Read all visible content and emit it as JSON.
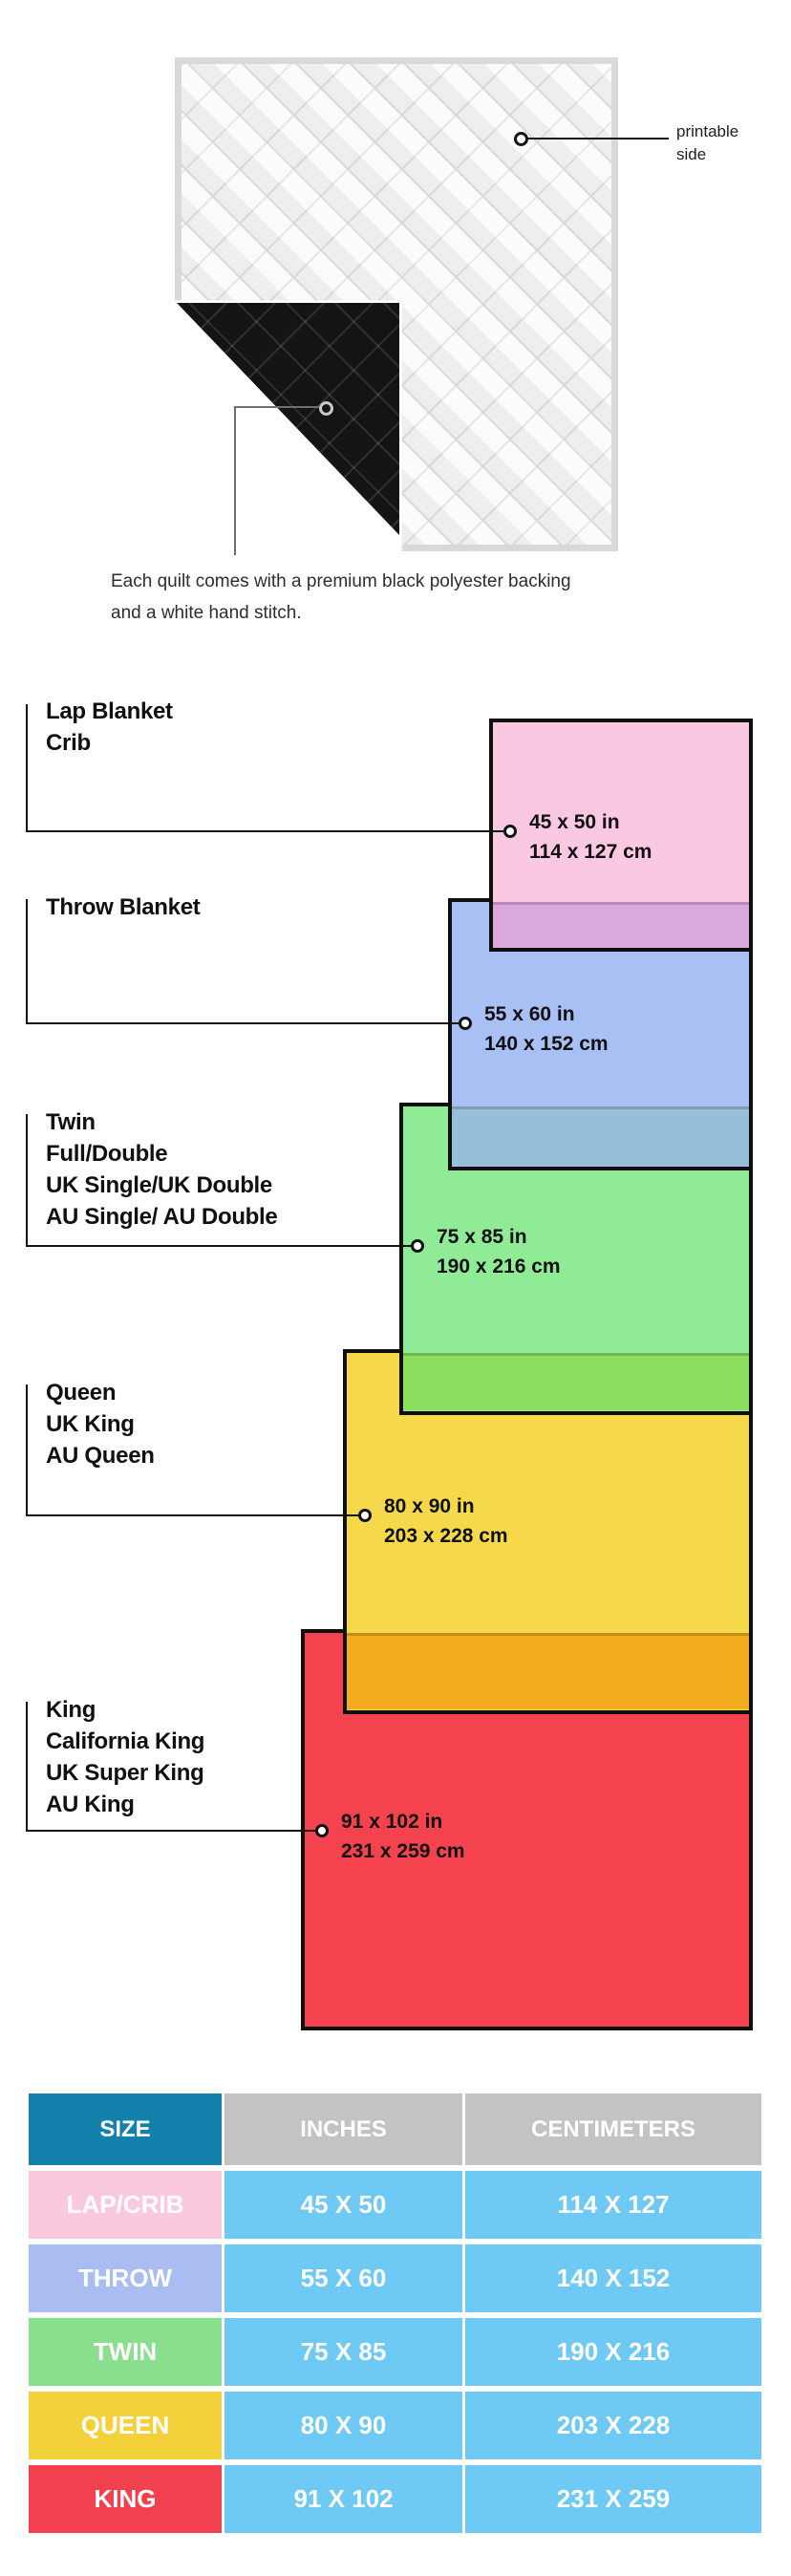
{
  "quilt": {
    "printable_label": "printable side",
    "caption": "Each quilt comes with a premium black polyester backing and a white hand stitch."
  },
  "diagram": {
    "sizes": [
      {
        "labels": [
          "Lap Blanket",
          "Crib"
        ],
        "inches": "45 x 50 in",
        "cm": "114 x 127 cm",
        "color": "#FBC8E1",
        "overlap_color": "#DAA8DC"
      },
      {
        "labels": [
          "Throw Blanket"
        ],
        "inches": "55 x 60 in",
        "cm": "140 x 152 cm",
        "color": "#A8C0F4",
        "overlap_color": "#97BFD9"
      },
      {
        "labels": [
          "Twin",
          "Full/Double",
          "UK Single/UK Double",
          "AU Single/ AU Double"
        ],
        "inches": "75 x 85 in",
        "cm": "190 x 216 cm",
        "color": "#90EB96",
        "overlap_color": "#8CDF5F"
      },
      {
        "labels": [
          "Queen",
          "UK King",
          "AU Queen"
        ],
        "inches": "80 x 90 in",
        "cm": "203 x 228 cm",
        "color": "#F5D94A",
        "overlap_color": "#F2AC1E"
      },
      {
        "labels": [
          "King",
          "California King",
          "UK Super King",
          "AU King"
        ],
        "inches": "91 x 102 in",
        "cm": "231 x 259 cm",
        "color": "#F5424F",
        "overlap_color": ""
      }
    ]
  },
  "table": {
    "headers": [
      "SIZE",
      "INCHES",
      "CENTIMETERS"
    ],
    "header_colors": {
      "size": "#1480AC",
      "others": "#C3C3C3"
    },
    "value_cell_color": "#6EC9F4",
    "rows": [
      {
        "size": "LAP/CRIB",
        "inches": "45 X 50",
        "cm": "114 X 127",
        "color": "#FBC9DD"
      },
      {
        "size": "THROW",
        "inches": "55 X 60",
        "cm": "140 X 152",
        "color": "#A9BDF2"
      },
      {
        "size": "TWIN",
        "inches": "75 X 85",
        "cm": "190 X 216",
        "color": "#8ADF8E"
      },
      {
        "size": "QUEEN",
        "inches": "80 X 90",
        "cm": "203 X 228",
        "color": "#F3D13B"
      },
      {
        "size": "KING",
        "inches": "91 X 102",
        "cm": "231 X 259",
        "color": "#F2414E"
      }
    ]
  }
}
